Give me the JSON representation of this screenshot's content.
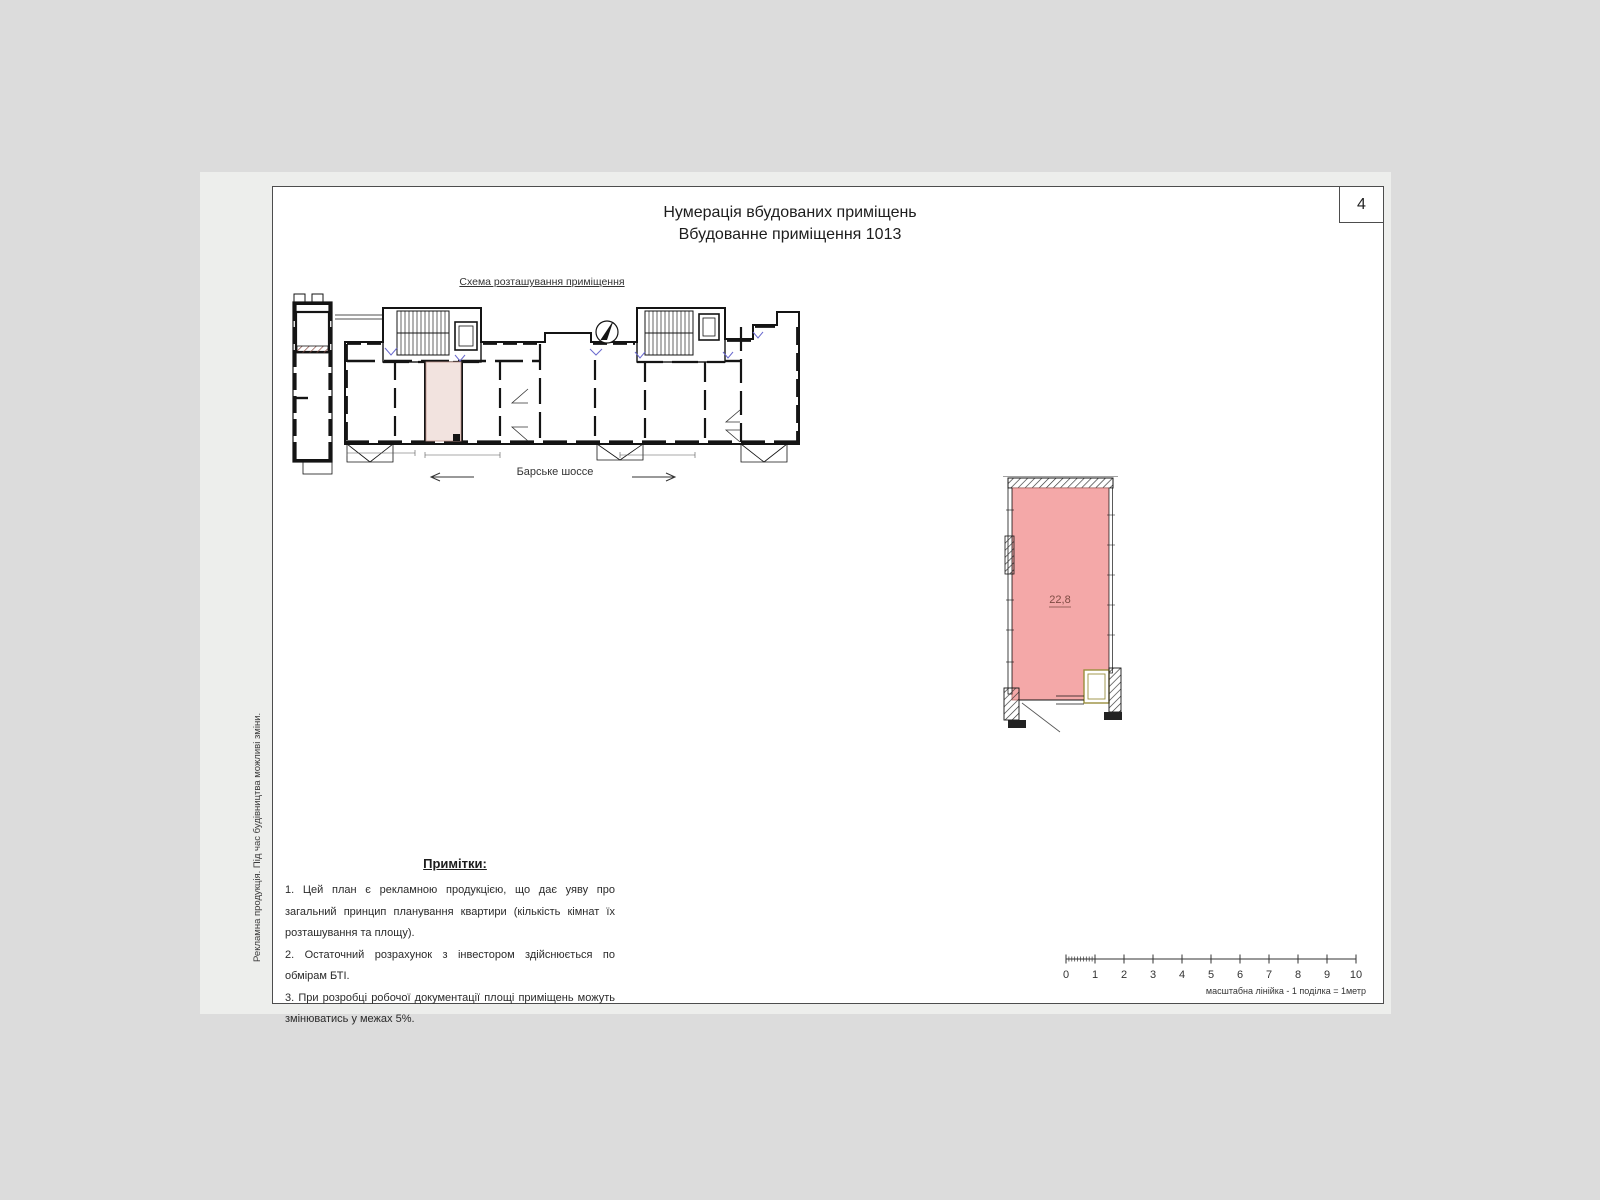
{
  "sheet": {
    "page_number": "4",
    "title_line1": "Нумерація вбудованих приміщень",
    "title_line2": "Вбудованне приміщення 1013",
    "side_note": "Рекламна продукція. Під час будівництва можливі зміни."
  },
  "location_scheme": {
    "label": "Схема розташування приміщення",
    "street_name": "Барське шоссе"
  },
  "unit_plan": {
    "area_label": "22,8"
  },
  "notes": {
    "heading": "Примітки:",
    "items": [
      "1. Цей план є рекламною продукцією, що дає уяву про загальний принцип планування квартири (кількість кімнат їх розташування та площу).",
      "2. Остаточний розрахунок з інвестором здійснюється по обмірам БТІ.",
      "3. При розробці робочої документації площі приміщень можуть змінюватись у межах 5%."
    ]
  },
  "scale_bar": {
    "tick_labels": [
      "0",
      "1",
      "2",
      "3",
      "4",
      "5",
      "6",
      "7",
      "8",
      "9",
      "10"
    ],
    "caption": "масштабна лінійка - 1 поділка = 1метр"
  },
  "colors": {
    "background": "#dcdcdc",
    "page": "#edeeec",
    "frame_border": "#4d4d4d",
    "wall": "#141414",
    "unit_fill": "#f4a8a8",
    "scheme_unit_fill": "#f2e3df",
    "area_text": "#7d4b43",
    "door_accent": "#6a6ace",
    "shaft_accent": "#9a8f3d"
  }
}
